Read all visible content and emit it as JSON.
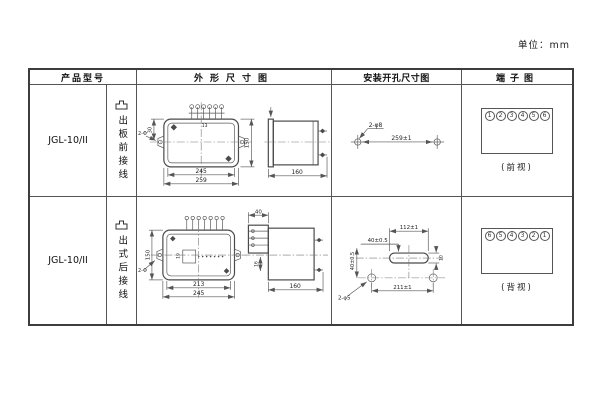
{
  "unit_label": "单位：mm",
  "colors": {
    "line": "#555555",
    "text": "#1a1a1a",
    "border": "#3d3d3d"
  },
  "icons": {
    "wiring_shape": "convex-outline-icon"
  },
  "table": {
    "headers": {
      "model": "产品型号",
      "outline": "外形尺寸图",
      "mounting": "安装开孔尺寸图",
      "terminal": "端子图"
    },
    "rows": [
      {
        "model": "JGL-10/II",
        "wiring_label": "出板前接线",
        "outline_dims": {
          "width_inner": "245",
          "width_outer": "259",
          "height": "150",
          "top_to_ear": "30",
          "terminal_pitch": "13",
          "ear_holes": "2-Φ",
          "depth": "160"
        },
        "mounting_dims": {
          "holes": "2-φ8",
          "spacing": "259±1"
        },
        "terminal_view": {
          "numbers": [
            "1",
            "2",
            "3",
            "4",
            "5",
            "6"
          ],
          "caption": "(前视)"
        }
      },
      {
        "model": "JGL-10/II",
        "wiring_label": "出式后接线",
        "outline_dims": {
          "width_inner": "213",
          "width_outer": "245",
          "height": "150",
          "inner_detail": "19",
          "ear_holes": "2-Φ",
          "block_depth": "40",
          "block_offset": "16",
          "depth": "160"
        },
        "mounting_dims": {
          "slot_width": "112±1",
          "slot_offset": "40±0.5",
          "vertical_offset": "40±0.5",
          "slot_height": "10",
          "holes": "2-φ5",
          "spacing": "211±1"
        },
        "terminal_view": {
          "numbers": [
            "6",
            "5",
            "4",
            "3",
            "2",
            "1"
          ],
          "caption": "(背视)"
        }
      }
    ]
  }
}
